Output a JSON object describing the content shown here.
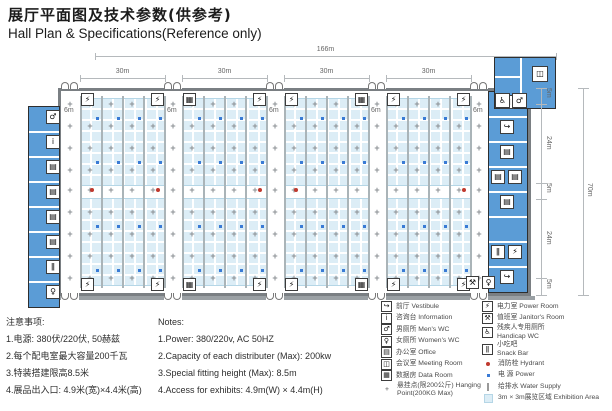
{
  "title": {
    "zh": "展厅平面图及技术参数(供参考)",
    "en": "Hall Plan & Specifications(Reference only)"
  },
  "plan": {
    "dim_total_width": "166m",
    "dim_bays": [
      "30m",
      "30m",
      "30m",
      "30m"
    ],
    "dim_aisle": "6m",
    "dim_right_segments": [
      "5m",
      "24m",
      "5m",
      "24m",
      "5m"
    ],
    "dim_total_height": "70m",
    "top_boxes": [
      [
        "power-room",
        "power-room"
      ],
      [
        "data-room",
        "power-room"
      ],
      [
        "power-room",
        "data-room"
      ],
      [
        "power-room",
        "power-room"
      ]
    ],
    "bottom_boxes": [
      [
        "power-room",
        "power-room"
      ],
      [
        "data-room",
        "power-room"
      ],
      [
        "power-room",
        "data-room"
      ],
      [
        "power-room",
        "power-room"
      ]
    ],
    "left_rooms": [
      "mens-wc",
      "information",
      "office",
      "office",
      "office",
      "office",
      "snack-bar",
      "womens-wc"
    ],
    "right_rooms": [
      [
        "office"
      ],
      [
        "vestibule"
      ],
      [
        "office"
      ],
      [
        "office",
        "office"
      ],
      [
        "office"
      ],
      [],
      [
        "snack-bar",
        "power-room"
      ],
      [
        "vestibule"
      ]
    ],
    "top_right_rooms": [
      "meeting-room"
    ],
    "top_right_boxes": [
      "handicap-wc",
      "mens-wc"
    ],
    "bottom_right_boxes": [
      "janitors-room",
      "womens-wc"
    ]
  },
  "icons": {
    "vestibule": "↪",
    "information": "i",
    "mens-wc": "♂",
    "womens-wc": "♀",
    "office": "▤",
    "meeting-room": "◫",
    "data-room": "▦",
    "power-room": "⚡",
    "janitors-room": "⚒",
    "handicap-wc": "♿",
    "snack-bar": "ǁ",
    "hydrant": "●",
    "power": "▪",
    "water-supply": "|",
    "hanging-point": "+"
  },
  "notes_zh": {
    "heading": "注意事项:",
    "items": [
      "1.电源: 380伏/220伏, 50赫兹",
      "2.每个配电室最大容量200千瓦",
      "3.特装搭建限高8.5米",
      "4.展品出入口: 4.9米(宽)×4.4米(高)"
    ]
  },
  "notes_en": {
    "heading": "Notes:",
    "items": [
      "1.Power: 380/220v, AC 50HZ",
      "2.Capacity of each distributer (Max): 200kw",
      "3.Special fitting height (Max): 8.5m",
      "4.Access for exhibits: 4.9m(W) × 4.4m(H)"
    ]
  },
  "legend": {
    "left": [
      {
        "icon": "vestibule",
        "label": "前厅 Vestibule",
        "style": "box"
      },
      {
        "icon": "information",
        "label": "咨询台 Information",
        "style": "box"
      },
      {
        "icon": "mens-wc",
        "label": "男厕所 Men's WC",
        "style": "box"
      },
      {
        "icon": "womens-wc",
        "label": "女厕所 Women's WC",
        "style": "box"
      },
      {
        "icon": "office",
        "label": "办公室 Office",
        "style": "box"
      },
      {
        "icon": "meeting-room",
        "label": "会议室 Meeting Room",
        "style": "box"
      },
      {
        "icon": "data-room",
        "label": "数据房 Data Room",
        "style": "box"
      }
    ],
    "right": [
      {
        "icon": "power-room",
        "label": "电力室 Power Room",
        "style": "box"
      },
      {
        "icon": "janitors-room",
        "label": "值班室 Janitor's Room",
        "style": "box"
      },
      {
        "icon": "handicap-wc",
        "label": "残疾人专用厕所\nHandicap WC",
        "style": "box"
      },
      {
        "icon": "snack-bar",
        "label": "小吃吧\nSnack Bar",
        "style": "box"
      },
      {
        "icon": "hydrant",
        "label": "消防栓 Hydrant",
        "style": "red-dot"
      },
      {
        "icon": "power",
        "label": "电  源 Power",
        "style": "blue-dot"
      },
      {
        "icon": "water-supply",
        "label": "给排水 Water Supply",
        "style": "line"
      },
      {
        "icon": "exhibition-area",
        "label": "3m × 3m展览区域 Exhibition Area",
        "style": "swatch"
      }
    ],
    "bottom": {
      "icon": "hanging-point",
      "label": "悬挂点(限200公斤) Hanging Point(200KG Max)",
      "style": "plain"
    }
  },
  "colors": {
    "room_blue": "#5b9cd6",
    "exhibit_fill": "#dcedf6",
    "exhibit_line": "#b5d6e6",
    "hydrant_red": "#c0392e",
    "power_blue": "#3a7bd5",
    "wall_gray": "#7a7f83",
    "line_gray": "#aab4b8"
  }
}
